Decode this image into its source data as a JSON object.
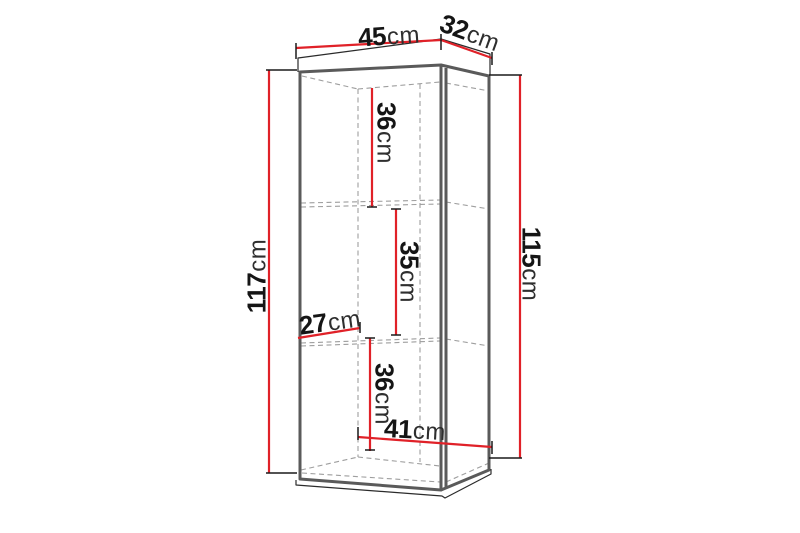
{
  "diagram": {
    "type": "furniture-dimension-drawing",
    "unit": "cm",
    "dims": {
      "width_top": {
        "v": "45",
        "u": "cm"
      },
      "depth_top": {
        "v": "32",
        "u": "cm"
      },
      "height_left": {
        "v": "117",
        "u": "cm"
      },
      "height_right": {
        "v": "115",
        "u": "cm"
      },
      "compartment_top": {
        "v": "36",
        "u": "cm"
      },
      "compartment_mid": {
        "v": "35",
        "u": "cm"
      },
      "inner_depth": {
        "v": "27",
        "u": "cm"
      },
      "compartment_bot": {
        "v": "36",
        "u": "cm"
      },
      "inner_width": {
        "v": "41",
        "u": "cm"
      }
    },
    "colors": {
      "dimension_line": "#e02128",
      "carcass_edge": "#5a5a5a",
      "hidden_edge": "#9e9e9e",
      "outline": "#2b2b2b",
      "tick": "#1a1a1a",
      "text": "#151515",
      "background": "#ffffff"
    }
  }
}
